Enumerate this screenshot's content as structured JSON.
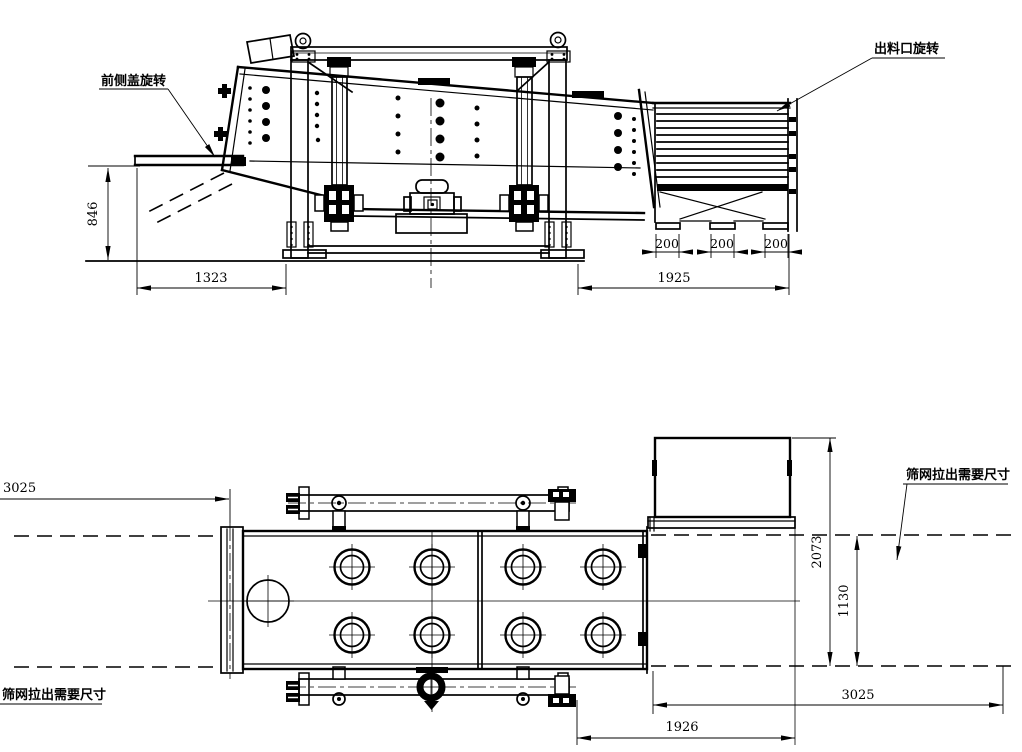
{
  "colors": {
    "line": "#000000",
    "background": "#ffffff"
  },
  "side_view": {
    "labels": {
      "front_cover_rotation": "前侧盖旋转",
      "discharge_outlet_rotation": "出料口旋转"
    },
    "dimensions": {
      "cover_open_height": "846",
      "feed_end_span": "1323",
      "discharge_end_span": "1925",
      "chute_widths": [
        "200",
        "200",
        "200"
      ]
    }
  },
  "plan_view": {
    "labels": {
      "screen_pullout_clearance_right": "筛网拉出需要尺寸",
      "screen_pullout_clearance_left": "筛网拉出需要尺寸"
    },
    "dimensions": {
      "pullout_left": "3025",
      "overall_width_with_hopper": "2073",
      "body_width": "1130",
      "pullout_right": "3025",
      "rear_section_length": "1926"
    }
  }
}
